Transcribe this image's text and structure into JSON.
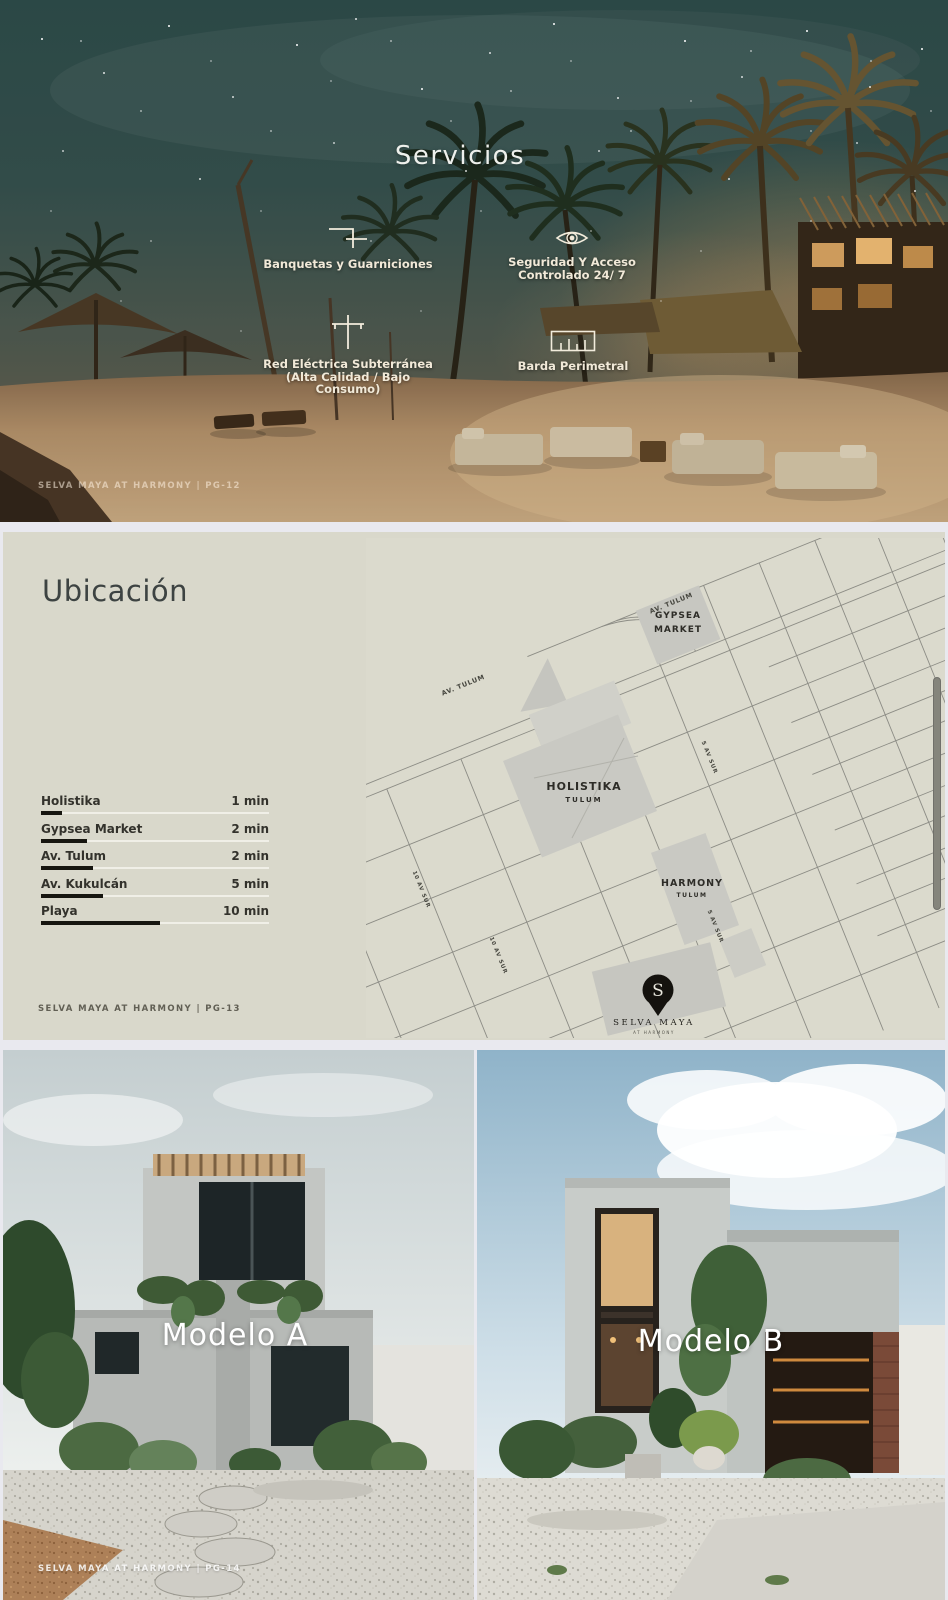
{
  "slide_servicios": {
    "title": "Servicios",
    "items": [
      {
        "icon": "curb-icon",
        "line1": "Banquetas y Guarniciones",
        "line2": ""
      },
      {
        "icon": "eye-icon",
        "line1": "Seguridad Y Acceso",
        "line2": "Controlado 24/ 7"
      },
      {
        "icon": "power-line-icon",
        "line1": "Red Eléctrica Subterránea",
        "line2": "(Alta Calidad / Bajo Consumo)"
      },
      {
        "icon": "perimeter-wall-icon",
        "line1": "Barda Perimetral",
        "line2": ""
      }
    ],
    "footer": "SELVA MAYA AT HARMONY | Pg-12"
  },
  "slide_ubicacion": {
    "title": "Ubicación",
    "distances": [
      {
        "label": "Holistika",
        "value": "1 min",
        "bar_pct": 9
      },
      {
        "label": "Gypsea Market",
        "value": "2 min",
        "bar_pct": 20
      },
      {
        "label": "Av. Tulum",
        "value": "2 min",
        "bar_pct": 23
      },
      {
        "label": "Av. Kukulcán",
        "value": "5 min",
        "bar_pct": 27
      },
      {
        "label": "Playa",
        "value": "10 min",
        "bar_pct": 52
      }
    ],
    "map": {
      "street_labels": {
        "av_tulum": "AV. TULUM",
        "av5": "5 AV SUR",
        "av10": "10 AV SUR"
      },
      "places": {
        "gypsea": {
          "line1": "GYPSEA",
          "line2": "MARKET"
        },
        "holistika": {
          "line1": "HOLISTIKA",
          "line2": "TULUM"
        },
        "harmony": {
          "line1": "HARMONY",
          "line2": "TULUM"
        }
      },
      "pin": {
        "initial": "S",
        "line1": "SELVA MAYA",
        "line2": "AT HARMONY"
      }
    },
    "footer": "SELVA MAYA AT HARMONY | Pg-13"
  },
  "slide_modelos": {
    "models": [
      {
        "label": "Modelo A"
      },
      {
        "label": "Modelo B"
      }
    ],
    "footer": "SELVA MAYA AT HARMONY | Pg-14"
  },
  "colors": {
    "page_gap": "#e9e9ef",
    "map_page_bg": "#d9d8cb",
    "map_block_gray": "#c8c8c2",
    "night_sky_teal": "#34504c",
    "sand": "#c7a87f",
    "bar_dark": "#171610"
  }
}
